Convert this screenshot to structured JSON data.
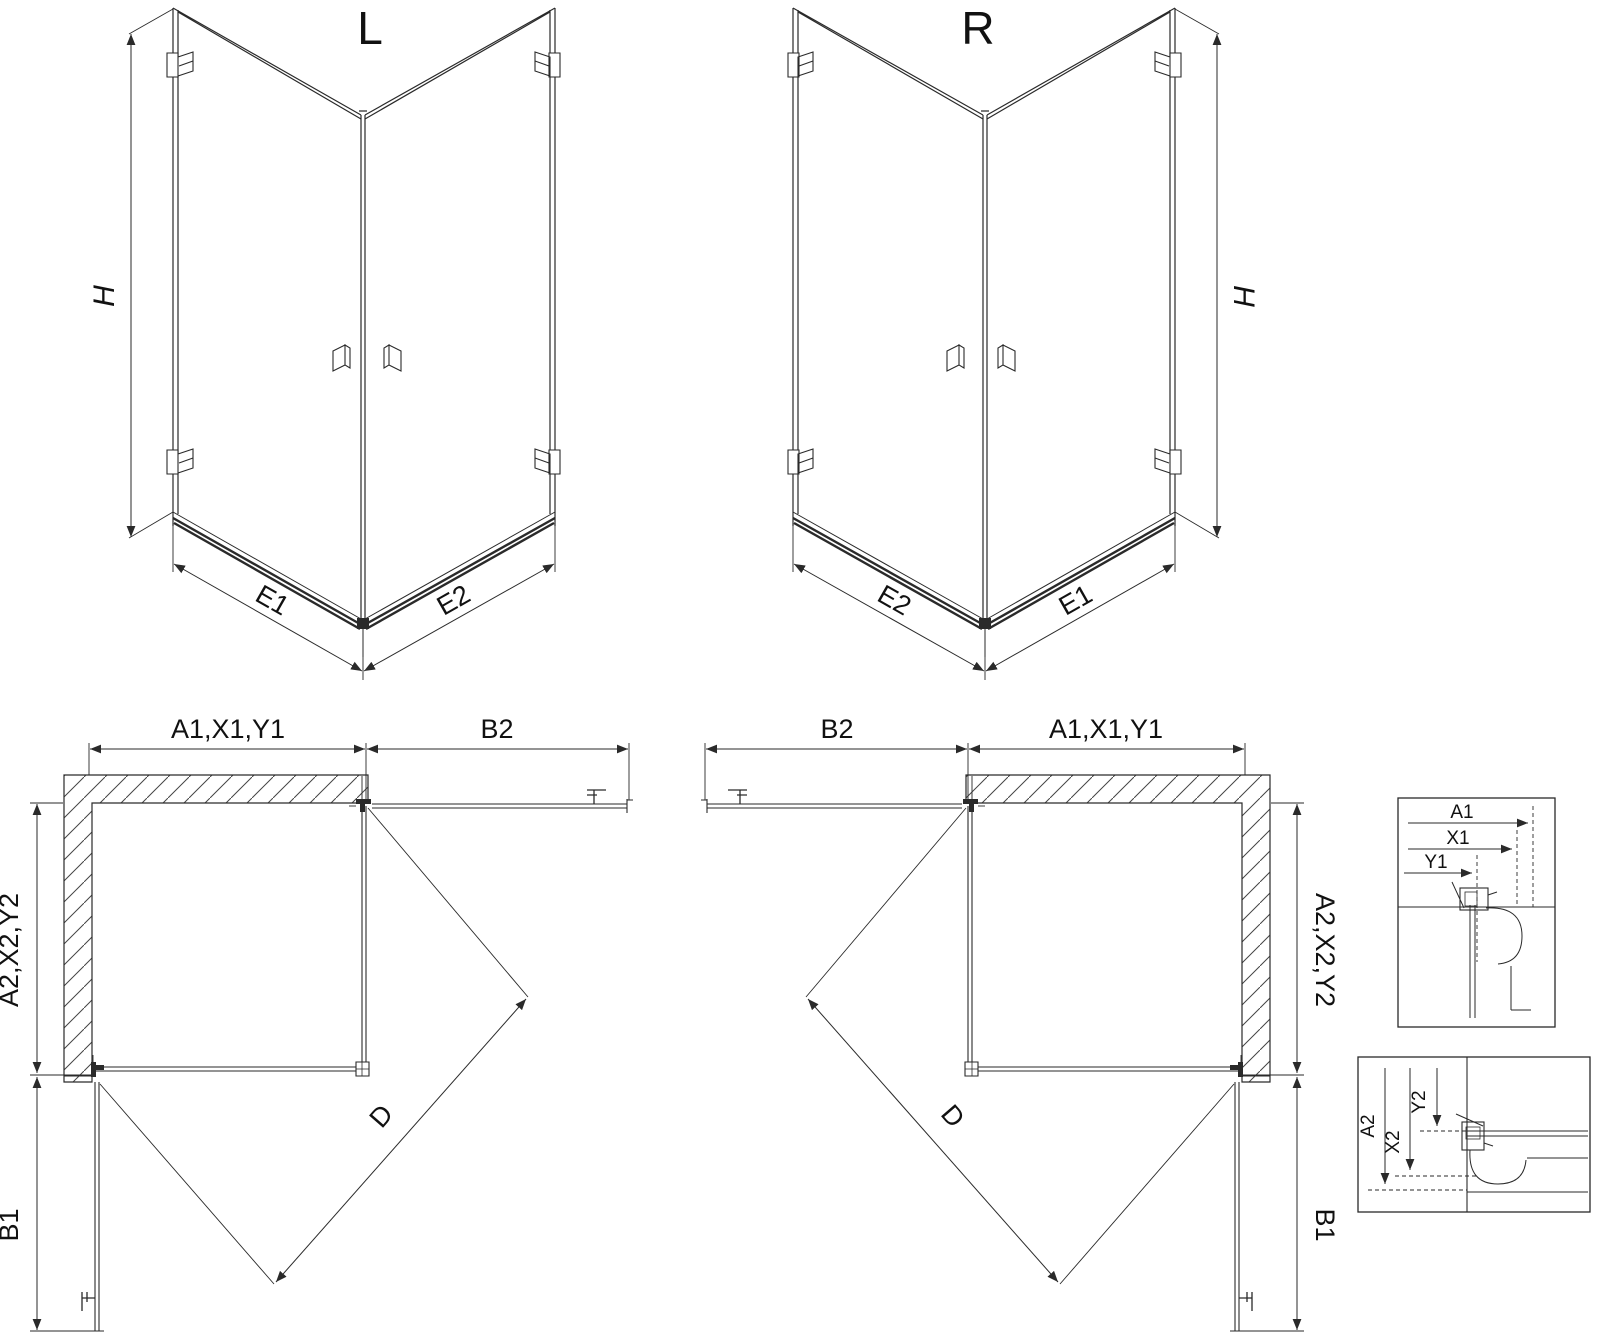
{
  "drawing": {
    "type": "shower-enclosure-technical-drawing",
    "views": {
      "left_3d": {
        "variant": "L"
      },
      "right_3d": {
        "variant": "R"
      }
    },
    "labels": {
      "variant_left": "L",
      "variant_right": "R",
      "height": "H",
      "e1": "E1",
      "e2": "E2",
      "front_width_group": "A1,X1,Y1",
      "side_width_group": "A2,X2,Y2",
      "door_front": "B2",
      "door_side": "B1",
      "entry_diagonal": "D",
      "detail_a1": "A1",
      "detail_x1": "X1",
      "detail_y1": "Y1",
      "detail_a2": "A2",
      "detail_x2": "X2",
      "detail_y2": "Y2"
    },
    "colors": {
      "line": "#2a2a2a",
      "background": "#ffffff",
      "hatch": "#444444"
    }
  }
}
